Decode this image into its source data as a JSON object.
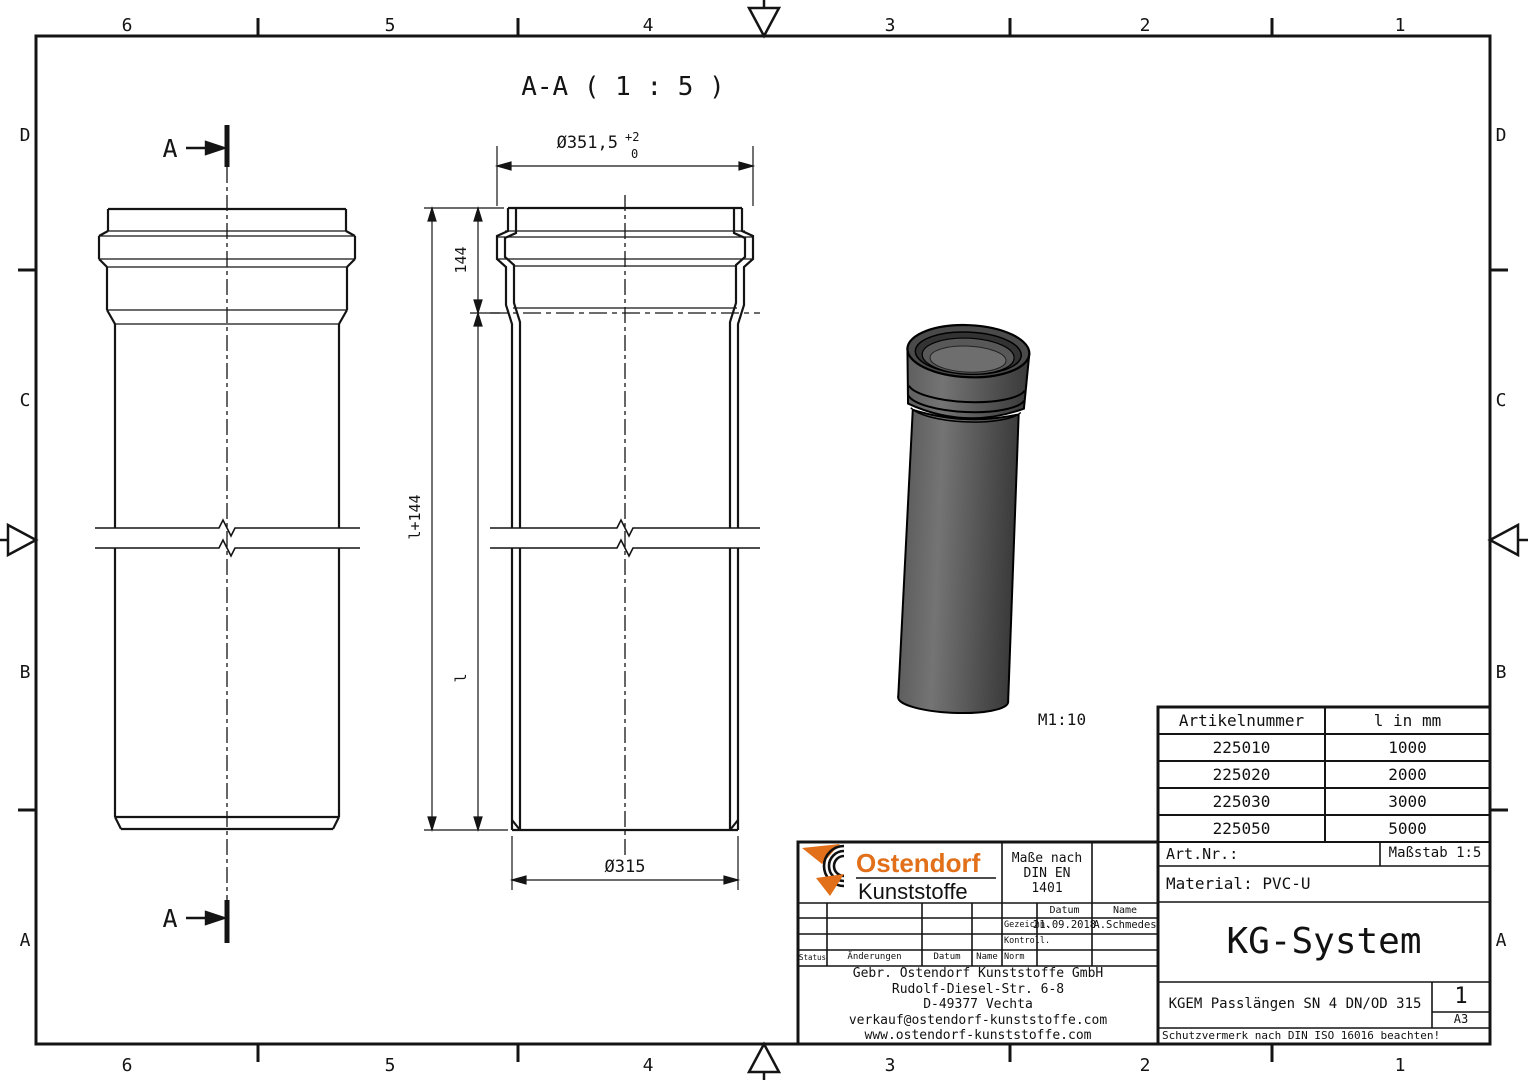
{
  "frame": {
    "columns_top": [
      "6",
      "5",
      "4",
      "3",
      "2",
      "1"
    ],
    "columns_bottom": [
      "6",
      "5",
      "4",
      "3",
      "2",
      "1"
    ],
    "rows_left": [
      "D",
      "C",
      "B",
      "A"
    ],
    "rows_right": [
      "D",
      "C",
      "B",
      "A"
    ]
  },
  "drawing": {
    "section_title": "A-A ( 1 : 5 )",
    "section_label_top": "A",
    "section_label_bottom": "A",
    "dim_socket_od": "Ø351,5",
    "dim_socket_od_tol_plus": "+2",
    "dim_socket_od_tol_minus": "0",
    "dim_socket_depth": "144",
    "dim_total_length": "l+144",
    "dim_length": "l",
    "dim_pipe_od": "Ø315",
    "render_scale": "M1:10"
  },
  "parts_table": {
    "headers": [
      "Artikelnummer",
      "l in mm"
    ],
    "rows": [
      [
        "225010",
        "1000"
      ],
      [
        "225020",
        "2000"
      ],
      [
        "225030",
        "3000"
      ],
      [
        "225050",
        "5000"
      ]
    ]
  },
  "title_block": {
    "art_nr_label": "Art.Nr.:",
    "scale_label": "Maßstab 1:5",
    "material": "Material: PVC-U",
    "system": "KG-System",
    "description": "KGEM Passlängen SN 4 DN/OD 315",
    "sheet_number": "1",
    "sheet_format": "A3",
    "protection_note": "Schutzvermerk nach DIN ISO 16016 beachten!",
    "dimensions_note": [
      "Maße nach",
      "DIN EN",
      "1401"
    ],
    "logo": {
      "line1": "Ostendorf",
      "line2": "Kunststoffe"
    },
    "revision": {
      "status_label": "Status",
      "changes_label": "Änderungen",
      "date_label": "Datum",
      "name_label": "Name",
      "date_header": "Datum",
      "name_header": "Name",
      "drawn_label": "Gezeichn.",
      "checked_label": "Kontroll.",
      "norm_label": "Norm",
      "drawn_date": "21.09.2018",
      "drawn_name": "A.Schmedes"
    },
    "company": [
      "Gebr. Ostendorf Kunststoffe GmbH",
      "Rudolf-Diesel-Str. 6-8",
      "D-49377 Vechta",
      "verkauf@ostendorf-kunststoffe.com",
      "www.ostendorf-kunststoffe.com"
    ]
  },
  "colors": {
    "logo_accent": "#e2701a",
    "line": "#141414",
    "pipe_gray": "#5a5a5a",
    "pipe_dark": "#2f2f2f"
  }
}
